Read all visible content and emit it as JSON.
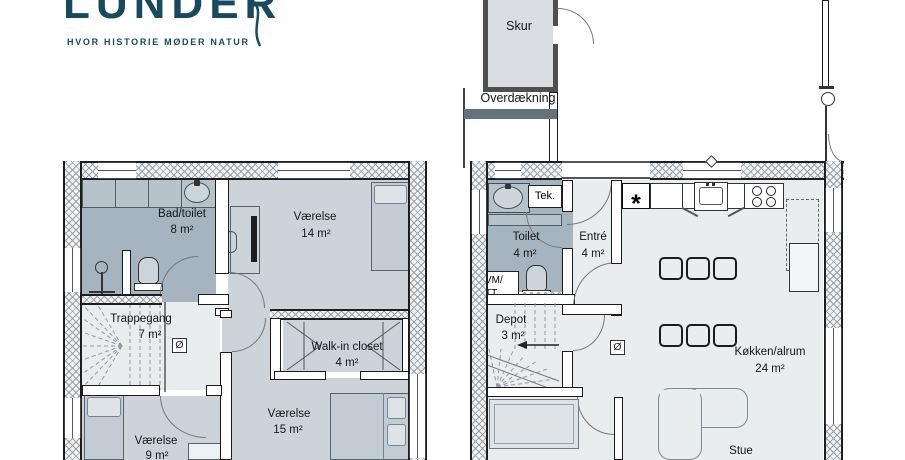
{
  "brand": {
    "logo_text": "LUNDER",
    "tagline": "HVOR HISTORIE MØDER NATUR",
    "color": "#174a5e"
  },
  "floor_upper": {
    "bad_toilet": {
      "name": "Bad/toilet",
      "area": "8 m²"
    },
    "vaerelse_14": {
      "name": "Værelse",
      "area": "14 m²"
    },
    "trappegang": {
      "name": "Trappegang",
      "area": "7 m²"
    },
    "walk_in_closet": {
      "name": "Walk-in closet",
      "area": "4 m²"
    },
    "vaerelse_15": {
      "name": "Værelse",
      "area": "15 m²"
    },
    "vaerelse_9": {
      "name": "Værelse",
      "area": "9 m²"
    },
    "floor_drain_symbol": "Ø"
  },
  "floor_ground": {
    "skur": {
      "name": "Skur"
    },
    "overdaekning": {
      "name": "Overdækning"
    },
    "toilet": {
      "name": "Toilet",
      "area": "4 m²"
    },
    "tek": {
      "name": "Tek."
    },
    "vm_tt": {
      "line1": "VM/",
      "line2": "TT"
    },
    "entre": {
      "name": "Entré",
      "area": "4 m²"
    },
    "depot": {
      "name": "Depot",
      "area": "3 m²"
    },
    "koekken_alrum": {
      "name": "Køkken/alrum",
      "area": "24 m²"
    },
    "stue": {
      "name": "Stue"
    },
    "star_symbol": "*",
    "floor_drain_symbol": "Ø"
  },
  "colors": {
    "wet_room_fill": "#a6b4c0",
    "bedroom_fill": "#ccd4d9",
    "hall_fill": "#e9edee",
    "shed_fill": "#d9dde1",
    "brand_teal": "#174a5e"
  }
}
